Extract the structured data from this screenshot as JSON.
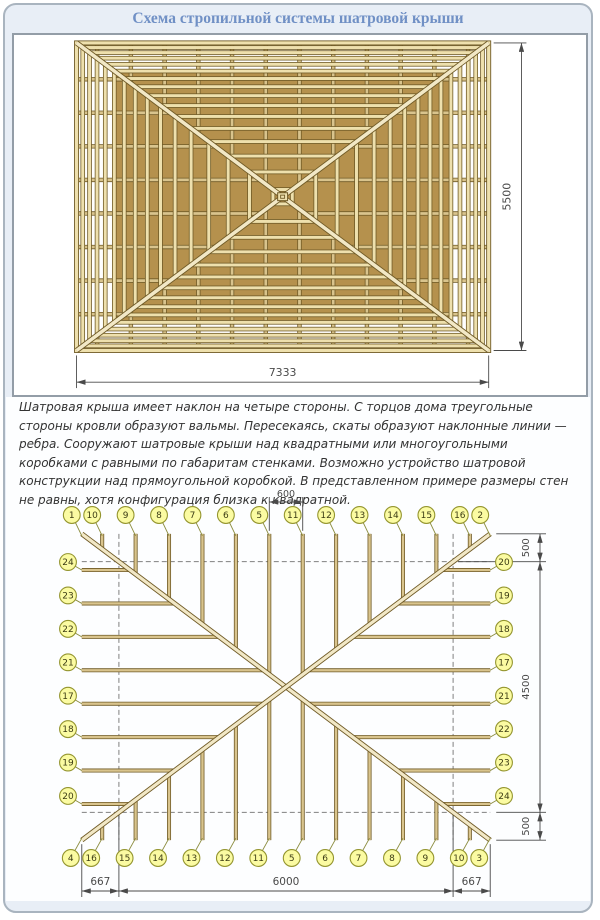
{
  "title": "Схема стропильной системы шатровой крыши",
  "description": "Шатровая крыша имеет наклон на четыре стороны. С торцов дома треугольные стороны кровли образуют вальмы. Пересекаясь, скаты образуют наклонные линии — ребра. Сооружают шатровые крыши над квадратными или многоугольными коробками с равными по габаритам стенками. Возможно устройство шатровой конструкции над прямоугольной коробкой. В представленном примере размеры стен не равны, хотя конфигурация близка к квадратной.",
  "plan": {
    "eaves_mm": {
      "width": 7333,
      "height": 5500
    },
    "wall_mm": {
      "width": 6000,
      "height": 4500
    },
    "dim_width_label": "7333",
    "dim_height_label": "5500",
    "rafter_offsets_mm": [
      300,
      900,
      1500,
      2100,
      2700,
      3300
    ],
    "side_rafter_offsets_mm": [
      300,
      900,
      1500,
      2100
    ]
  },
  "layout": {
    "dim_top_label": "600",
    "dims_right": [
      "500",
      "4500",
      "500"
    ],
    "dims_bottom": [
      "667",
      "6000",
      "667"
    ],
    "top_labels": [
      "1",
      "10",
      "9",
      "8",
      "7",
      "6",
      "5",
      "11",
      "12",
      "13",
      "14",
      "15",
      "16",
      "2"
    ],
    "bottom_labels": [
      "4",
      "16",
      "15",
      "14",
      "13",
      "12",
      "11",
      "5",
      "6",
      "7",
      "8",
      "9",
      "10",
      "3"
    ],
    "left_labels": [
      "24",
      "23",
      "22",
      "21",
      "17",
      "18",
      "19",
      "20"
    ],
    "right_labels": [
      "20",
      "19",
      "18",
      "17",
      "21",
      "22",
      "23",
      "24"
    ]
  },
  "colors": {
    "panel_bg": "#e8eef6",
    "title": "#7090c5",
    "dim": "#4a4a4a",
    "dash": "#808080",
    "wood_core": "#eee0ad",
    "wood_mid": "#d9c48d",
    "wood_deck": "#b5914d",
    "wood_edge": "#6f5a26",
    "hip_core": "#f2e8c6",
    "circle_fill": "#fbfba2",
    "circle_edge": "#94952f",
    "circle_text": "#3c3c14",
    "leader": "#8b8c3e"
  }
}
